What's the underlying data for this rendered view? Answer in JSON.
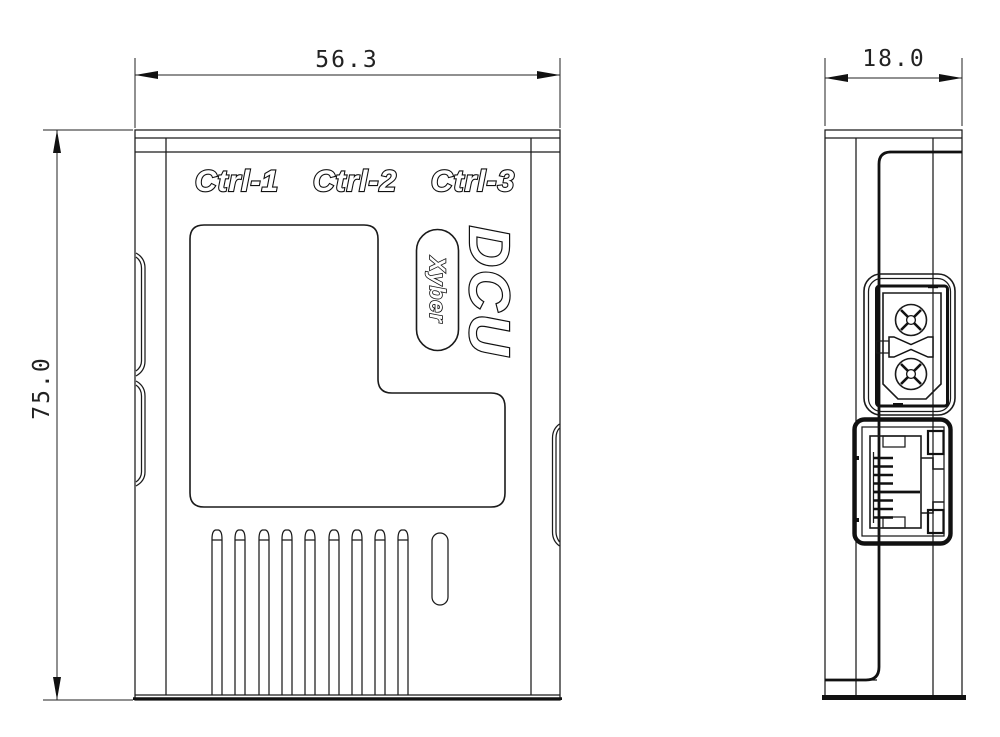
{
  "page": {
    "background": "#ffffff",
    "line_color": "#1a1a1a"
  },
  "front_view": {
    "dim_width": {
      "value": "56.3"
    },
    "dim_height": {
      "value": "75.0"
    },
    "ctrl_labels": [
      {
        "label": "Ctrl-1"
      },
      {
        "label": "Ctrl-2"
      },
      {
        "label": "Ctrl-3"
      }
    ],
    "product": "DCU",
    "brand": "Xyber",
    "vents": {
      "slot_count": 9,
      "pill_slot_count": 1
    }
  },
  "side_view": {
    "dim_depth": {
      "value": "18.0"
    },
    "ports": [
      {
        "name": "power-connector"
      },
      {
        "name": "ethernet-port"
      }
    ]
  }
}
